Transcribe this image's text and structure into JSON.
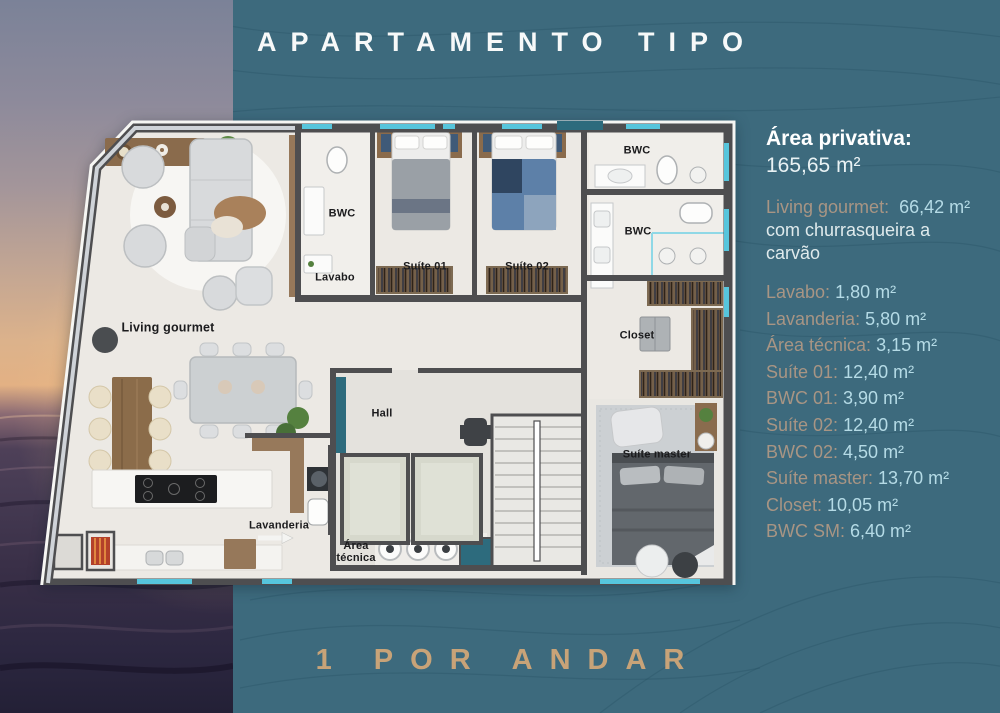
{
  "title": "APARTAMENTO TIPO",
  "footer": "1 POR ANDAR",
  "area_panel": {
    "heading": "Área privativa:",
    "heading_value": "165,65 m²",
    "living": {
      "label": "Living gourmet:",
      "value": "66,42 m²",
      "note": "com churrasqueira a carvão"
    },
    "rows": [
      {
        "label": "Lavabo:",
        "value": "1,80 m²"
      },
      {
        "label": "Lavanderia:",
        "value": "5,80 m²"
      },
      {
        "label": "Área técnica:",
        "value": "3,15 m²"
      },
      {
        "label": "Suíte 01:",
        "value": "12,40 m²"
      },
      {
        "label": "BWC 01:",
        "value": "3,90 m²"
      },
      {
        "label": "Suíte 02:",
        "value": "12,40 m²"
      },
      {
        "label": "BWC 02:",
        "value": "4,50 m²"
      },
      {
        "label": "Suíte master:",
        "value": "13,70 m²"
      },
      {
        "label": "Closet:",
        "value": "10,05 m²"
      },
      {
        "label": "BWC SM:",
        "value": "6,40 m²"
      }
    ]
  },
  "floor_plan": {
    "labels": [
      {
        "text": "BWC"
      },
      {
        "text": "Lavabo"
      },
      {
        "text": "Suíte 01"
      },
      {
        "text": "Suíte 02"
      },
      {
        "text": "BWC"
      },
      {
        "text": "BWC"
      },
      {
        "text": "Closet"
      },
      {
        "text": "Living gourmet"
      },
      {
        "text": "Hall"
      },
      {
        "text": "Suíte master"
      },
      {
        "text": "Lavanderia"
      },
      {
        "text": "Área técnica"
      }
    ]
  },
  "colors": {
    "background_teal": "#3d6a7d",
    "contour_line": "#1f4a5e",
    "accent_tan": "#c8a378",
    "label_tan": "#a89584",
    "value_blue": "#b5dbe6",
    "wall_gray": "#4e4e50",
    "floor_offwhite": "#ece9e4",
    "window_cyan": "#56c5dc",
    "door_teal": "#2d6b7d"
  }
}
